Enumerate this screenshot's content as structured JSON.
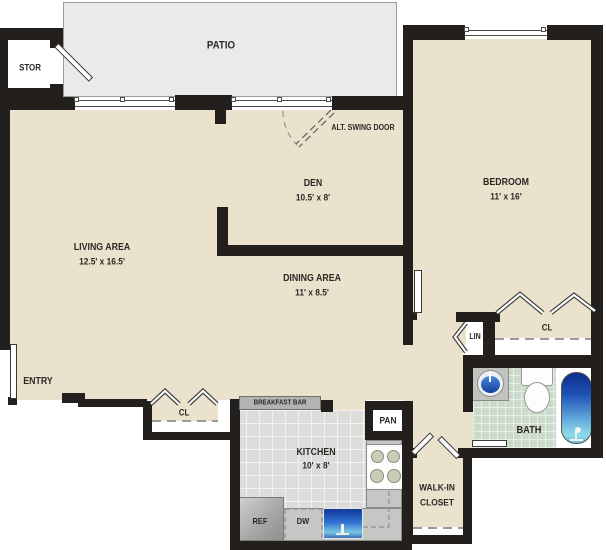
{
  "title": "One-bedroom apartment floor plan",
  "labels": {
    "patio": "PATIO",
    "stor": "STOR",
    "alt_swing_door": "ALT. SWING DOOR",
    "den": "DEN",
    "den_dims": "10.5' x 8'",
    "bedroom": "BEDROOM",
    "bedroom_dims": "11' x 16'",
    "living": "LIVING AREA",
    "living_dims": "12.5' x 16.5'",
    "dining": "DINING AREA",
    "dining_dims": "11' x 8.5'",
    "entry": "ENTRY",
    "cl_living": "CL",
    "cl_bedroom": "CL",
    "lin": "LIN",
    "bath": "BATH",
    "kitchen": "KITCHEN",
    "kitchen_dims": "10' x 8'",
    "pan": "PAN",
    "breakfast_bar": "BREAKFAST BAR",
    "ref": "REF",
    "dw": "DW",
    "walkin_line1": "WALK-IN",
    "walkin_line2": "CLOSET"
  },
  "colors": {
    "floor": "#eae2cc",
    "wall": "#221f1d",
    "patio": "#eaeaea",
    "kitchen_tile": "#dcdcda",
    "bath_tile": "#ccdacb",
    "counter": "#c6c6c4",
    "appliance_gray": "#b3b3b1",
    "tub_top": "#0d2d8a",
    "tub_bottom": "#8edce9",
    "sink_blue": "#2f6fd0"
  }
}
